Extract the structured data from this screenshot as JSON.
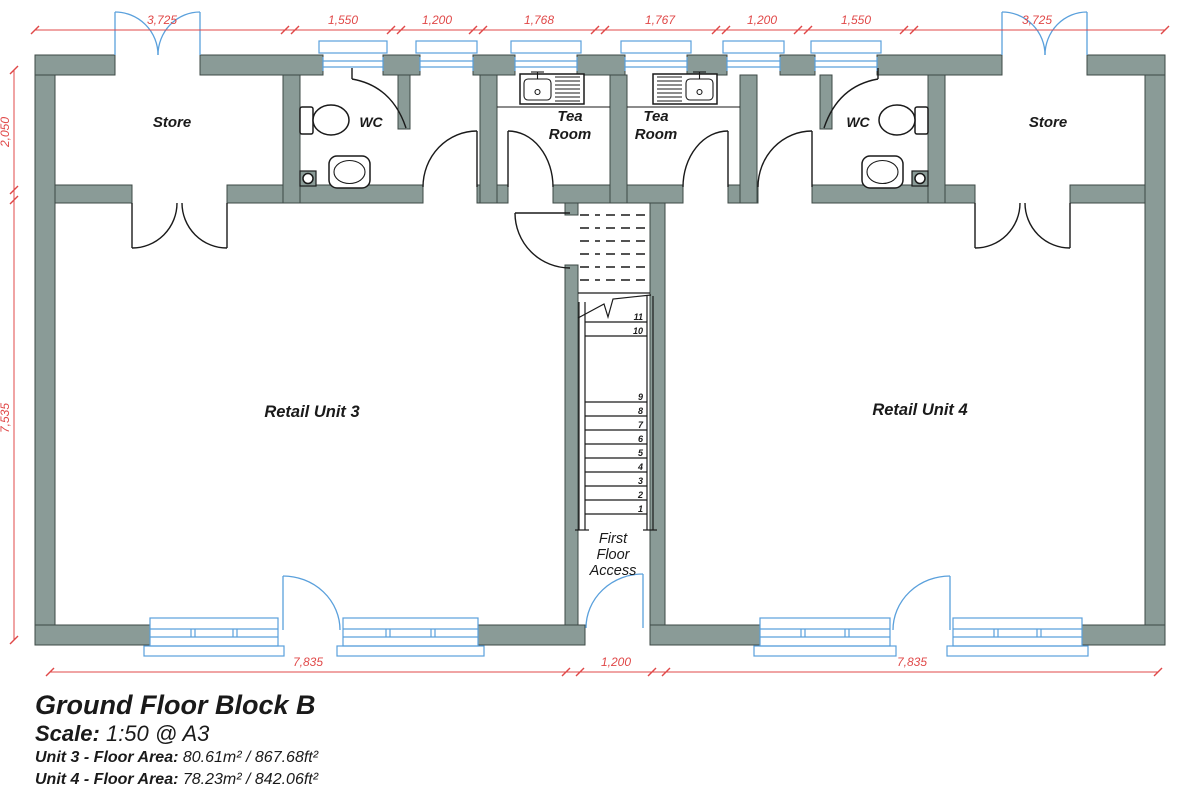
{
  "title_block": {
    "title": "Ground Floor Block B",
    "scale_label": "Scale:",
    "scale_value": "1:50 @ A3",
    "unit3_label": "Unit 3 - Floor Area:",
    "unit3_value": "80.61m² / 867.68ft²",
    "unit4_label": "Unit 4 - Floor Area:",
    "unit4_value": "78.23m² / 842.06ft²"
  },
  "rooms": {
    "store_left": "Store",
    "store_right": "Store",
    "wc_left": "WC",
    "wc_right": "WC",
    "tea_room": {
      "line1": "Tea",
      "line2": "Room"
    },
    "retail_unit_3": "Retail Unit 3",
    "retail_unit_4": "Retail Unit 4",
    "stair_access": {
      "line1": "First",
      "line2": "Floor",
      "line3": "Access"
    }
  },
  "stairs": {
    "numbers": [
      "11",
      "10",
      "9",
      "8",
      "7",
      "6",
      "5",
      "4",
      "3",
      "2",
      "1"
    ]
  },
  "dimensions": {
    "top": [
      "3,725",
      "1,550",
      "1,200",
      "1,768",
      "1,767",
      "1,200",
      "1,550",
      "3,725"
    ],
    "left": [
      "2,050",
      "7,535"
    ],
    "bottom": [
      "7,835",
      "1,200",
      "7,835"
    ]
  },
  "colors": {
    "wall": "#8a9b97",
    "wall_outline": "#3c4845",
    "glazing": "#5aa0dc",
    "dimension": "#e04848",
    "line": "#1a1a1a",
    "background": "#ffffff"
  }
}
